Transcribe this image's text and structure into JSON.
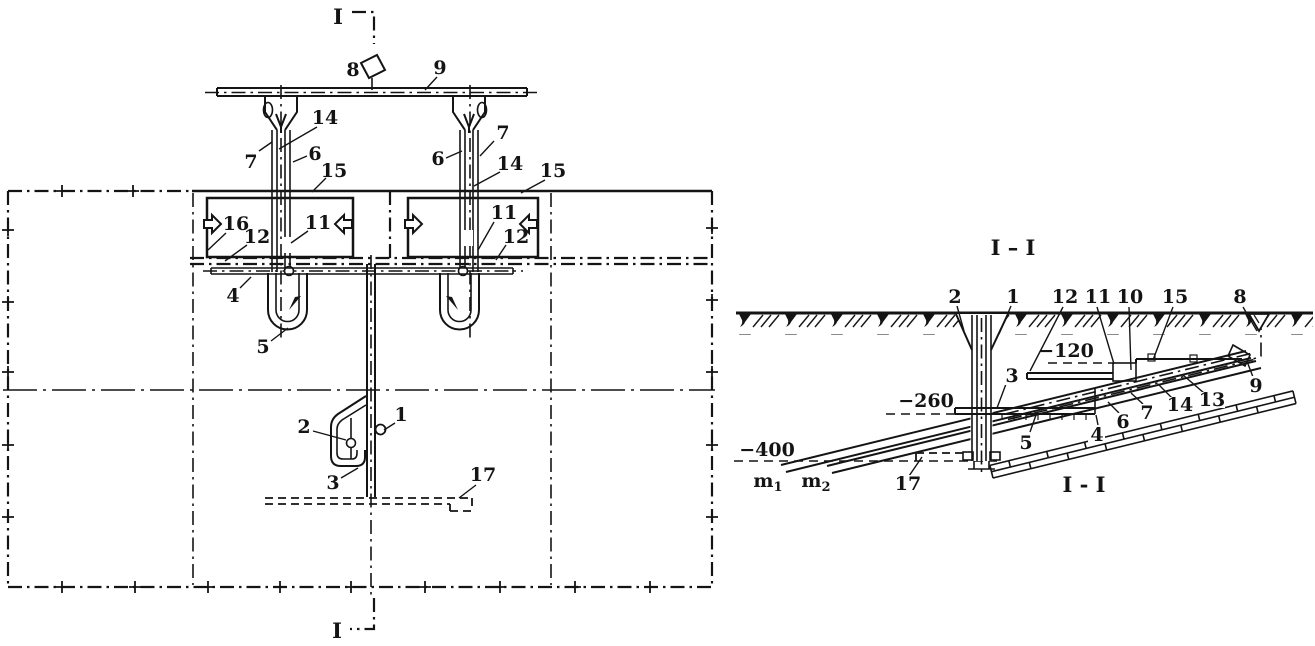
{
  "drawing": {
    "background_color": "#ffffff",
    "ink_color": "#141414"
  },
  "plan_view": {
    "marker_top": "I",
    "marker_bottom": "I",
    "callouts": {
      "c1": "1",
      "c2": "2",
      "c3": "3",
      "c4": "4",
      "c5": "5",
      "c6": "6",
      "c7": "7",
      "c8": "8",
      "c9": "9",
      "c11": "11",
      "c12": "12",
      "c14": "14",
      "c15": "15",
      "c16": "16",
      "c17": "17"
    }
  },
  "section_view": {
    "title": "I – I",
    "caption": "I - I",
    "elevations": {
      "e120": "−120",
      "e260": "−260",
      "e400": "−400"
    },
    "seams": {
      "m1": {
        "base": "m",
        "sub": "1"
      },
      "m2": {
        "base": "m",
        "sub": "2"
      }
    },
    "callouts": {
      "c1": "1",
      "c2": "2",
      "c3": "3",
      "c4": "4",
      "c5": "5",
      "c6": "6",
      "c7": "7",
      "c8": "8",
      "c9": "9",
      "c10": "10",
      "c11": "11",
      "c12": "12",
      "c13": "13",
      "c14": "14",
      "c15": "15",
      "c17": "17"
    }
  }
}
